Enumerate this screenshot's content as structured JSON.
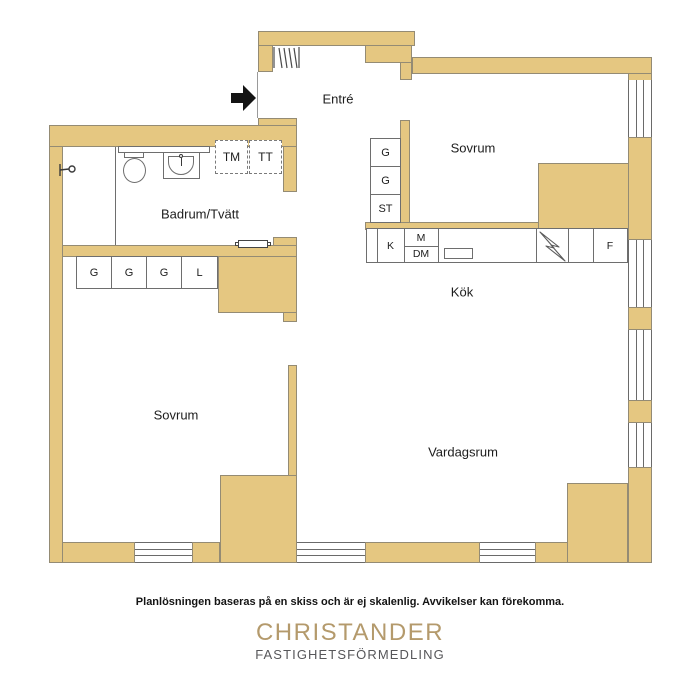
{
  "colors": {
    "wall_fill": "#e5c781",
    "wall_outline": "#948b74",
    "fixture_line": "#6e6e6e",
    "text": "#1d1d1d",
    "brand_gold": "#b49a6c",
    "brand_gray": "#57575a"
  },
  "rooms": {
    "entre": "Entré",
    "sovrum_top": "Sovrum",
    "badrum": "Badrum/Tvätt",
    "kok": "Kök",
    "sovrum_bottom": "Sovrum",
    "vardagsrum": "Vardagsrum"
  },
  "closets": {
    "bedroom_top": [
      "G",
      "G",
      "ST"
    ],
    "bedroom_bottom": [
      "G",
      "G",
      "G",
      "L"
    ]
  },
  "laundry": {
    "washer": "TM",
    "dryer": "TT"
  },
  "kitchen": {
    "fridge": "K",
    "microwave": "M",
    "dishwasher": "DM",
    "freezer": "F"
  },
  "icons": [
    "entry-arrow",
    "coat-rack",
    "shower-mixer",
    "toilet",
    "bathroom-sink",
    "radiator",
    "kitchen-sink",
    "stove-zigzag"
  ],
  "footer": {
    "disclaimer": "Planlösningen baseras på en skiss och är ej skalenlig. Avvikelser kan förekomma.",
    "brand_name": "CHRISTANDER",
    "brand_subtitle": "FASTIGHETSFÖRMEDLING"
  }
}
